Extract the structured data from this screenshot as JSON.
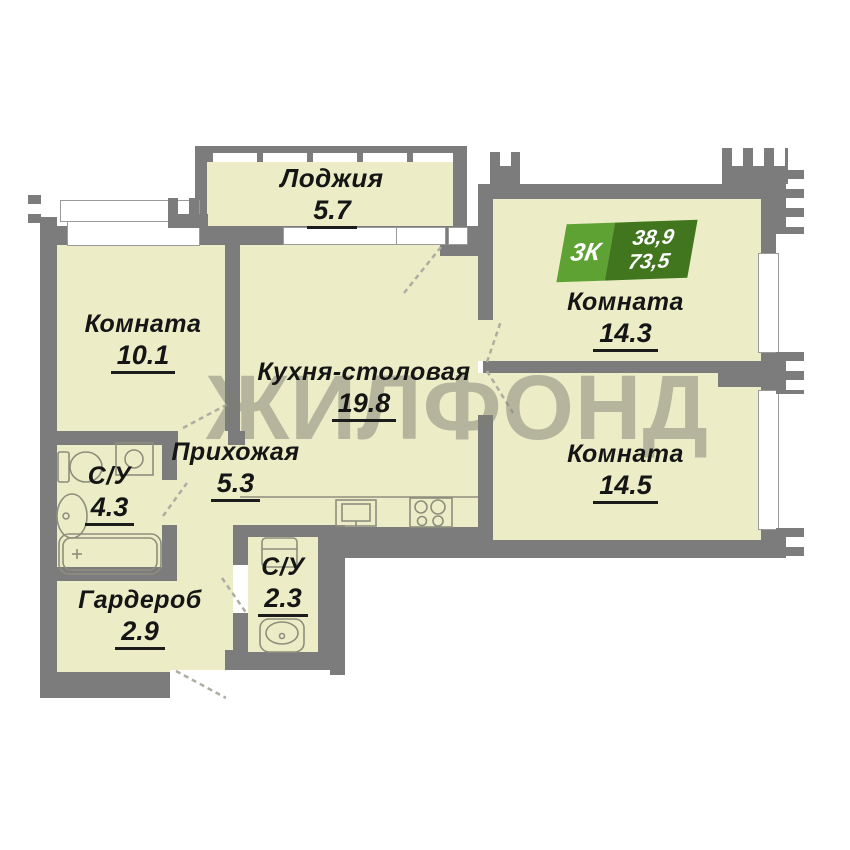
{
  "watermark": "ЖИЛФОНД",
  "badge": {
    "rooms_label": "3К",
    "living_area": "38,9",
    "total_area": "73,5"
  },
  "rooms": [
    {
      "name": "Лоджия",
      "area": "5.7"
    },
    {
      "name": "Комната",
      "area": "10.1"
    },
    {
      "name": "Кухня-столовая",
      "area": "19.8"
    },
    {
      "name": "Комната",
      "area": "14.3"
    },
    {
      "name": "Комната",
      "area": "14.5"
    },
    {
      "name": "Прихожая",
      "area": "5.3"
    },
    {
      "name": "С/У",
      "area": "4.3"
    },
    {
      "name": "С/У",
      "area": "2.3"
    },
    {
      "name": "Гардероб",
      "area": "2.9"
    }
  ],
  "colors": {
    "wall_gray": "#7c7c7c",
    "room_fill": "#ecedc6",
    "badge_light_green": "#5da233",
    "badge_dark_green": "#41761f",
    "watermark_gray": "#7d7d73",
    "fixture_outline": "#8e8e7e"
  }
}
